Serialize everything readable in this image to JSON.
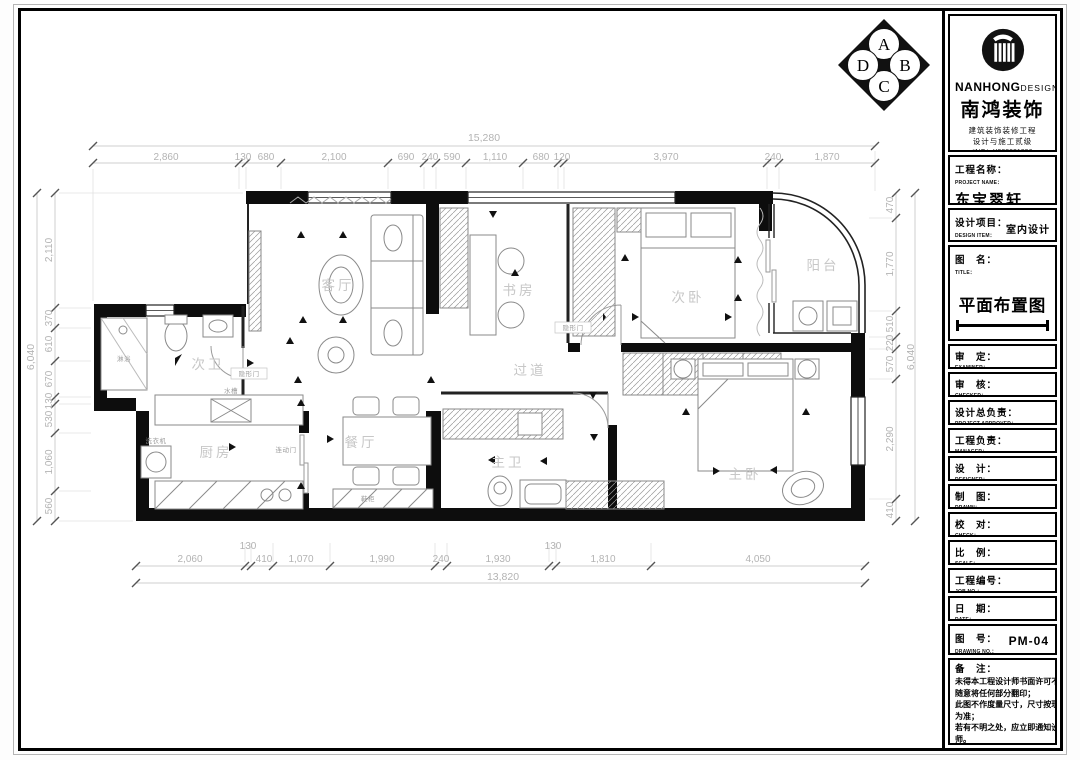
{
  "compass": {
    "letters": [
      "A",
      "B",
      "C",
      "D"
    ]
  },
  "logo": {
    "brand_top": "NANHONG",
    "brand_top2": "DESIGN",
    "brand_cn": "南鸿装饰",
    "cert1": "建筑装饰装修工程",
    "cert2": "设计与施工贰级",
    "cert_no": "*NO：X233021396"
  },
  "titleblock": {
    "project": {
      "cn": "工程名称：",
      "en": "PROJECT NAME：",
      "value": "东宝翠轩"
    },
    "design_item": {
      "cn": "设计项目：",
      "en": "DESIGN ITEM：",
      "value": "室内设计"
    },
    "drawing_title": {
      "cn": "图　名：",
      "en": "TITLE：",
      "value": "平面布置图"
    },
    "rows": [
      {
        "cn": "审　定：",
        "en": "EXAMINER："
      },
      {
        "cn": "审　核：",
        "en": "CHECKED："
      },
      {
        "cn": "设计总负责：",
        "en": "PROJECT APPROVED："
      },
      {
        "cn": "工程负责：",
        "en": "MANAGER："
      },
      {
        "cn": "设　计：",
        "en": "DESIGNER："
      },
      {
        "cn": "制　图：",
        "en": "DRAWN："
      },
      {
        "cn": "校　对：",
        "en": "CHECK："
      },
      {
        "cn": "比　例：",
        "en": "SCALE："
      },
      {
        "cn": "工程编号：",
        "en": "JOB NO.："
      },
      {
        "cn": "日　期：",
        "en": "DATE："
      }
    ],
    "drawing_no": {
      "cn": "图　号：",
      "en": "DRAWING NO.：",
      "value": "PM-04"
    },
    "notes": {
      "cn": "备　注：",
      "lines": [
        "未得本工程设计师书面许可不得",
        "随意将任何部分翻印；",
        "此图不作度量尺寸，尺寸按现场",
        "为准；",
        "若有不明之处，应立即通知设计",
        "师。"
      ],
      "footer": "本设计解释权归设计师所有。"
    }
  },
  "plan": {
    "rooms": {
      "living": "客厅",
      "study": "书房",
      "bedroom2": "次卧",
      "balcony": "阳台",
      "bath2": "次卫",
      "kitchen": "厨房",
      "dining": "餐厅",
      "corridor": "过道",
      "bath1": "主卫",
      "bedroom1": "主卧"
    },
    "annotations": {
      "hidden_door": "隐形门",
      "sliding_door": "连动门",
      "sink": "水槽",
      "washer": "洗衣机",
      "shoe_cabinet": "鞋柜",
      "shower": "淋浴"
    },
    "dims": {
      "top_total": "15,280",
      "top": [
        "2,860",
        "130",
        "680",
        "2,100",
        "690",
        "240",
        "590",
        "1,110",
        "680",
        "120",
        "3,970",
        "240",
        "1,870"
      ],
      "bottom": [
        "2,060",
        "130",
        "410",
        "1,070",
        "1,990",
        "240",
        "1,930",
        "130",
        "1,810",
        "4,050"
      ],
      "bottom_total": "13,820",
      "left": [
        "2,110",
        "370",
        "610",
        "670",
        "130",
        "530",
        "1,060",
        "560"
      ],
      "left_total": "6,040",
      "right": [
        "470",
        "1,770",
        "510",
        "220",
        "570",
        "2,290",
        "410"
      ],
      "right_total": "6,040"
    }
  }
}
